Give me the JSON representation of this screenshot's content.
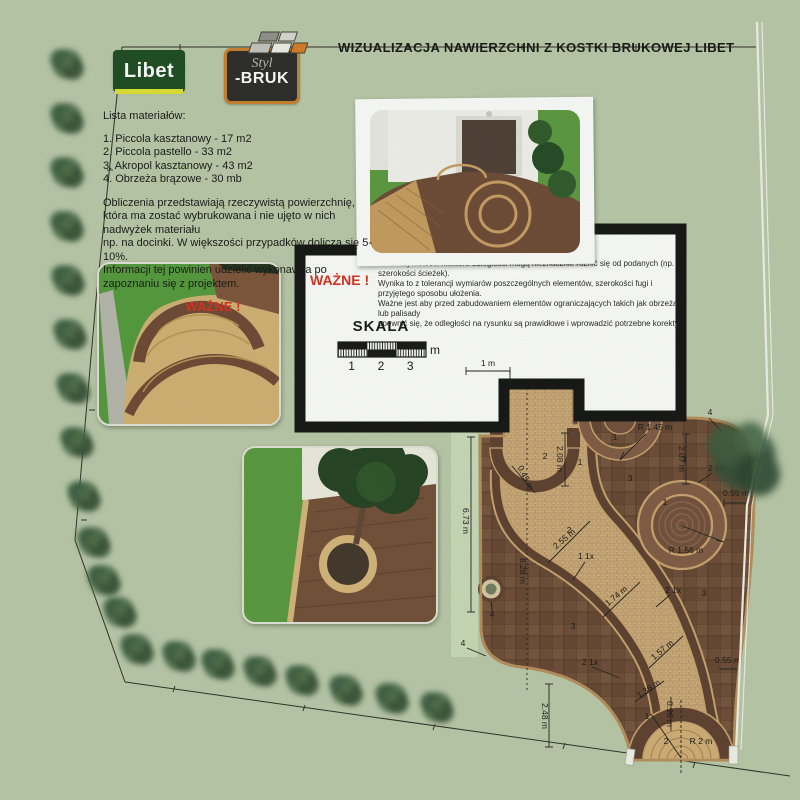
{
  "header": {
    "title": "WIZUALIZACJA NAWIERZCHNI Z KOSTKI BRUKOWEJ LIBET",
    "libet_logo_text": "Libet",
    "stylbruk_logo_line1": "Styl",
    "stylbruk_logo_line2": "-BRUK"
  },
  "materials": {
    "heading": "Lista materiałów:",
    "items": [
      "1. Piccola kasztanowy - 17 m2",
      "2. Piccola pastello - 33 m2",
      "3. Akropol kasztanowy - 43 m2",
      "4. Obrzeża brązowe - 30 mb"
    ],
    "note_lines": [
      "Obliczenia przedstawiają rzeczywistą powierzchnię,",
      "która ma zostać wybrukowana i nie ujęto w nich nadwyżek materiału",
      "np. na docinki. W większości przypadków dolicza się 5-10%.",
      "Informacji tej powinien udzielić wykonawca po zapoznaniu się z projektem."
    ],
    "warning_label": "WAŻNE !"
  },
  "notice_box": {
    "warning_label": "WAŻNE !",
    "lines": [
      "W rzeczywistości niektóre odległości mogą nieznacznie różnić się od podanych (np. szerokości ścieżek).",
      "Wynika to z tolerancji wymiarów poszczególnych elementów, szerokości fugi i przyjętego sposobu ułożenia.",
      "Ważne jest aby przed zabudowaniem elementów ograniczających takich jak obrzeża lub palisady",
      "upewnić się, że odległości na rysunku są prawidłowe i wprowadzić potrzebne korekty."
    ]
  },
  "scale_bar": {
    "title": "SKALA",
    "unit": "m",
    "ticks": [
      "1",
      "2",
      "3"
    ]
  },
  "plan": {
    "dimension_labels": [
      {
        "text": "1 m",
        "x": 488,
        "y": 366,
        "rot": 0
      },
      {
        "text": "2.08 m",
        "x": 557,
        "y": 459,
        "rot": 90
      },
      {
        "text": "0.45 m",
        "x": 523,
        "y": 479,
        "rot": 65
      },
      {
        "text": "2",
        "x": 545,
        "y": 459,
        "rot": 0
      },
      {
        "text": "1",
        "x": 580,
        "y": 465,
        "rot": 0
      },
      {
        "text": "2",
        "x": 569,
        "y": 533,
        "rot": 0
      },
      {
        "text": "1",
        "x": 615,
        "y": 440,
        "rot": 0
      },
      {
        "text": "R 1.45 m",
        "x": 655,
        "y": 430,
        "rot": 0
      },
      {
        "text": "3",
        "x": 630,
        "y": 481,
        "rot": 0
      },
      {
        "text": "3",
        "x": 684,
        "y": 462,
        "rot": 0
      },
      {
        "text": "2 1x",
        "x": 716,
        "y": 471,
        "rot": 0
      },
      {
        "text": "4",
        "x": 710,
        "y": 415,
        "rot": 0
      },
      {
        "text": "2.07 m",
        "x": 679,
        "y": 459,
        "rot": 90
      },
      {
        "text": "0.55 m",
        "x": 736,
        "y": 496,
        "rot": 0
      },
      {
        "text": "1",
        "x": 665,
        "y": 505,
        "rot": 0
      },
      {
        "text": "R 1.56 m",
        "x": 686,
        "y": 553,
        "rot": 0
      },
      {
        "text": "2 1x",
        "x": 673,
        "y": 593,
        "rot": 0
      },
      {
        "text": "3",
        "x": 704,
        "y": 596,
        "rot": 0
      },
      {
        "text": "2.55 m",
        "x": 566,
        "y": 541,
        "rot": -40
      },
      {
        "text": "1 1x",
        "x": 586,
        "y": 559,
        "rot": 0
      },
      {
        "text": "8.28 m",
        "x": 520,
        "y": 571,
        "rot": 90
      },
      {
        "text": "6.73 m",
        "x": 463,
        "y": 521,
        "rot": 90
      },
      {
        "text": "1.74 m",
        "x": 618,
        "y": 598,
        "rot": -40
      },
      {
        "text": "3",
        "x": 573,
        "y": 629,
        "rot": 0
      },
      {
        "text": "4",
        "x": 492,
        "y": 617,
        "rot": 0
      },
      {
        "text": "4",
        "x": 463,
        "y": 646,
        "rot": 0
      },
      {
        "text": "1.57 m",
        "x": 664,
        "y": 652,
        "rot": -40
      },
      {
        "text": "2 1x",
        "x": 590,
        "y": 665,
        "rot": 0
      },
      {
        "text": "1.36 m",
        "x": 650,
        "y": 691,
        "rot": -33
      },
      {
        "text": "0.96 m",
        "x": 667,
        "y": 714,
        "rot": 90
      },
      {
        "text": "0.55 m",
        "x": 728,
        "y": 663,
        "rot": 0
      },
      {
        "text": "2.48 m",
        "x": 542,
        "y": 716,
        "rot": 90
      },
      {
        "text": "1",
        "x": 647,
        "y": 719,
        "rot": 0
      },
      {
        "text": "2",
        "x": 666,
        "y": 744,
        "rot": 0
      },
      {
        "text": "R 2 m",
        "x": 701,
        "y": 744,
        "rot": 0
      }
    ]
  },
  "colors": {
    "paper_green": "#b9c8a9",
    "libet_green": "#17471c",
    "libet_yellow": "#dde22e",
    "warning_red": "#d92a1a",
    "pastello_paving": "#cdaa79",
    "kasztan_band": "#5a3b2b",
    "akropol_dark": "#6b4733",
    "edging_brown": "#b68c58",
    "fence_white": "#f2f2ea"
  }
}
